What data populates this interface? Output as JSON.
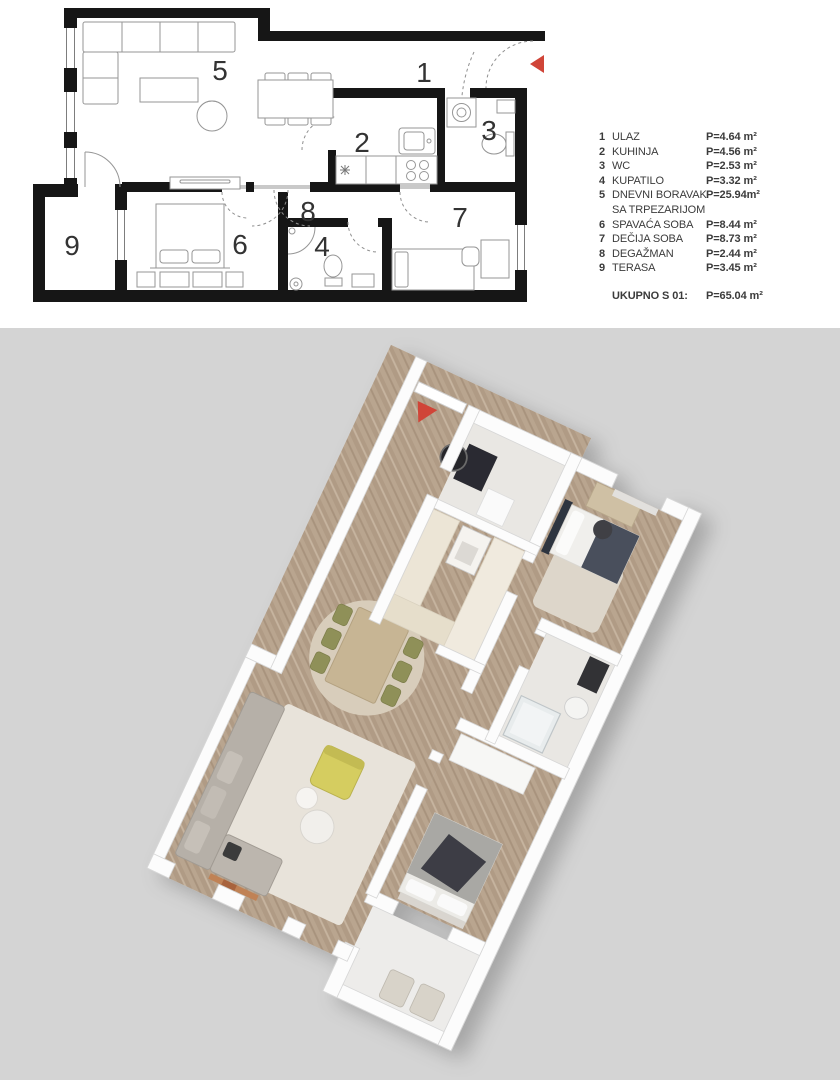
{
  "legend": {
    "rows": [
      {
        "num": "1",
        "name": "ULAZ",
        "area": "P=4.64 m²"
      },
      {
        "num": "2",
        "name": "KUHINJA",
        "area": "P=4.56 m²"
      },
      {
        "num": "3",
        "name": "WC",
        "area": "P=2.53 m²"
      },
      {
        "num": "4",
        "name": "KUPATILO",
        "area": "P=3.32 m²"
      },
      {
        "num": "5",
        "name": "DNEVNI BORAVAK",
        "name_line2": "SA TRPEZARIJOM",
        "area": "P=25.94m²"
      },
      {
        "num": "6",
        "name": "SPAVAĆA SOBA",
        "area": "P=8.44 m²"
      },
      {
        "num": "7",
        "name": "DEČIJA SOBA",
        "area": "P=8.73 m²"
      },
      {
        "num": "8",
        "name": "DEGAŽMAN",
        "area": "P=2.44 m²"
      },
      {
        "num": "9",
        "name": "TERASA",
        "area": "P=3.45 m²"
      }
    ],
    "total_label": "UKUPNO S 01:",
    "total_area": "P=65.04 m²"
  },
  "plan2d": {
    "room_numbers": [
      "1",
      "2",
      "3",
      "4",
      "5",
      "6",
      "7",
      "8",
      "9"
    ]
  },
  "colors": {
    "marker_red": "#d04538",
    "wall_black": "#161616",
    "bg_gray": "#d4d4d4"
  }
}
